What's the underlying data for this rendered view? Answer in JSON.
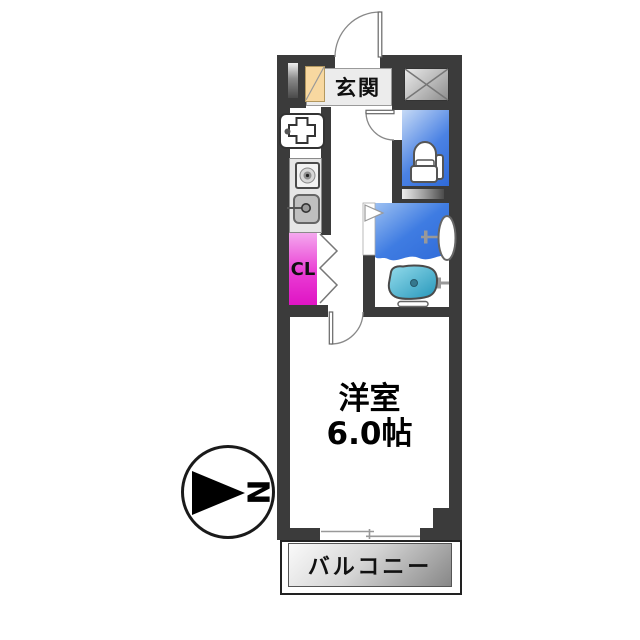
{
  "floorplan": {
    "labels": {
      "entrance": "玄関",
      "closet": "CL",
      "main_room": "洋室",
      "main_room_size": "6.0帖",
      "balcony": "バルコニー",
      "compass": "N"
    },
    "colors": {
      "wall": "#3b3b3b",
      "toilet_room_blue": "#3c78dc",
      "bathroom_blue": "#3a7ae0",
      "bathtub_teal": "#45b0cc",
      "closet_magenta": "#e018c8",
      "shoe_cabinet_tan": "#f8d8a0",
      "entrance_floor_gray": "#ececec",
      "shaft_gray": "#9a9a9a",
      "balcony_gray": "#878787"
    },
    "icons": [
      "entrance-door-icon",
      "shoe-cabinet-icon",
      "shaft-cross-icon",
      "gas-stove-icon",
      "burner-icon",
      "kitchen-sink-icon",
      "closet-folding-door-icon",
      "toilet-icon",
      "washbasin-icon",
      "bathtub-icon",
      "bathroom-door-icon",
      "sliding-window-icon",
      "compass-icon"
    ]
  }
}
